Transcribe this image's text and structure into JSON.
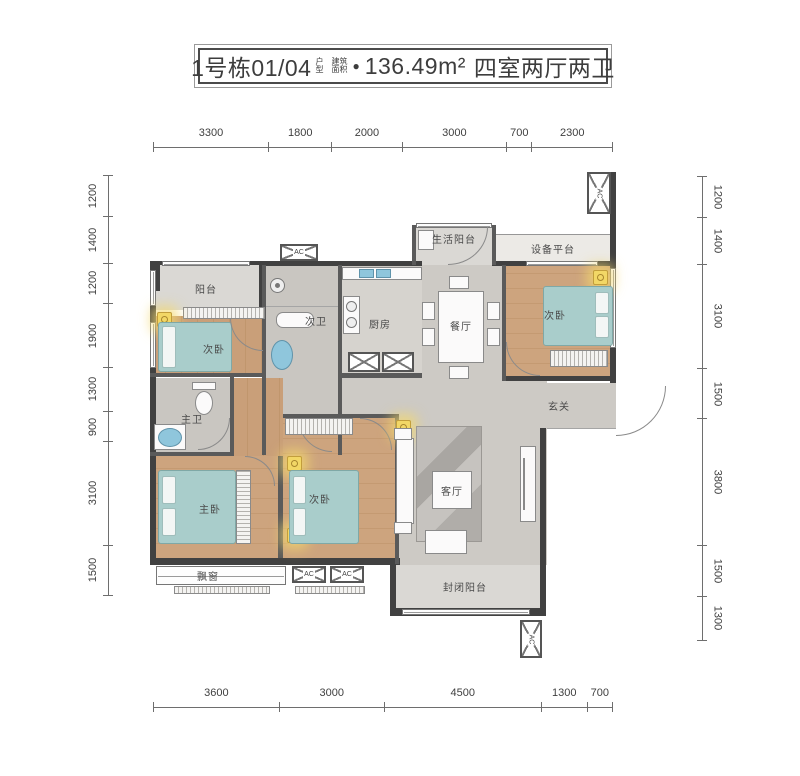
{
  "title": {
    "building_unit": "1号栋01/04",
    "unit_type_small_1": "户",
    "unit_type_small_2": "型",
    "area_label_small_1": "建筑",
    "area_label_small_2": "面积",
    "bullet": "●",
    "area_value": "136.49m²",
    "layout_summary": "四室两厅两卫"
  },
  "dimensions": {
    "top": [
      "3300",
      "1800",
      "2000",
      "3000",
      "700",
      "2300"
    ],
    "bottom": [
      "3600",
      "3000",
      "4500",
      "1300",
      "700"
    ],
    "left": [
      "1200",
      "1400",
      "1200",
      "1900",
      "1300",
      "900",
      "3100",
      "1500"
    ],
    "right": [
      "1200",
      "1400",
      "3100",
      "1500",
      "3800",
      "1500",
      "1300"
    ]
  },
  "rooms": {
    "balcony": "阳台",
    "bedroom_top_left": "次卧",
    "bath_secondary": "次卫",
    "kitchen": "厨房",
    "service_balcony": "生活阳台",
    "equipment_platform": "设备平台",
    "dining_room": "餐厅",
    "bedroom_top_right": "次卧",
    "entry_hall": "玄关",
    "master_bath": "主卫",
    "master_bedroom": "主卧",
    "bedroom_bottom": "次卧",
    "living_room": "客厅",
    "enclosed_balcony": "封闭阳台",
    "bay_window": "飘窗"
  },
  "labels": {
    "ac_unit": "AC"
  },
  "colors": {
    "wall": "#414141",
    "wood_floor": "#c99f79",
    "hall_floor": "#cdcac5",
    "tile_floor": "#c9c6c1",
    "balcony_floor": "#dad8d4",
    "bed": "#a9cdcb",
    "fixture_blue": "#8fc6dc",
    "light_accent": "#f2d766",
    "title_text": "#3d3d3d"
  }
}
